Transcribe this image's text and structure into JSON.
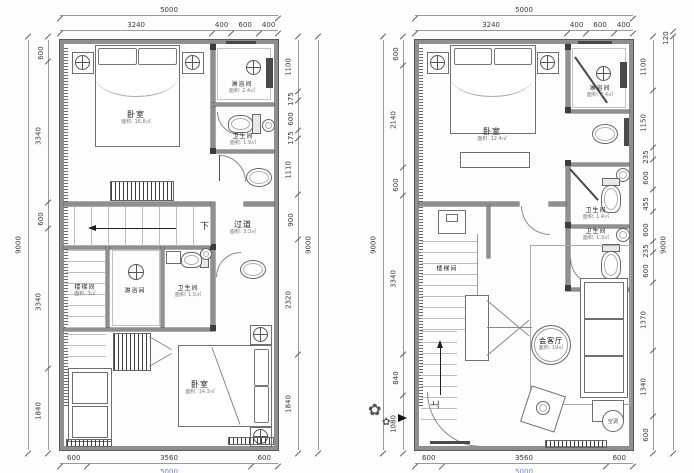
{
  "plans": {
    "left": {
      "dims": {
        "top_overall": [
          "5000"
        ],
        "top": [
          "3240",
          "400",
          "600",
          "400"
        ],
        "left_outer": [
          "9000"
        ],
        "left": [
          "600",
          "3340",
          "600",
          "3340",
          "1840"
        ],
        "right": [
          "1100",
          "175",
          "600",
          "175",
          "1110",
          "900",
          "2320",
          "1840"
        ],
        "right_outer": [
          "9000"
        ],
        "bottom": [
          "600",
          "3560",
          "600"
        ],
        "bottom_overall": [
          "5000"
        ]
      },
      "rooms": {
        "bedroom1": {
          "name": "卧室",
          "area": "面积: 16.8㎡"
        },
        "shower1": {
          "name": "淋浴间",
          "area": "面积: 2.4㎡"
        },
        "toilet1": {
          "name": "卫生间",
          "area": "面积: 1.9㎡"
        },
        "corridor": {
          "name": "过道",
          "area": "面积: 3.3㎡"
        },
        "stairwell": {
          "name": "楼梯间",
          "area": "面积: 3㎡"
        },
        "shower2": {
          "name": "淋浴间",
          "area": "面积: 2.8㎡"
        },
        "toilet2": {
          "name": "卫生间",
          "area": "面积: 1.5㎡"
        },
        "bedroom2": {
          "name": "卧室",
          "area": "面积: 14.3㎡"
        }
      },
      "down_label": "下"
    },
    "right": {
      "dims": {
        "top_overall": [
          "5000"
        ],
        "top": [
          "3240",
          "400",
          "600",
          "400"
        ],
        "left_outer": [
          "9000"
        ],
        "left": [
          "600",
          "2140",
          "600",
          "3340",
          "840",
          "1080"
        ],
        "right": [
          "1100",
          "1150",
          "235",
          "600",
          "455",
          "600",
          "235",
          "600",
          "1370",
          "1340",
          "600"
        ],
        "right_outer": [
          "120",
          "9000"
        ],
        "bottom": [
          "600",
          "3560",
          "600"
        ],
        "bottom_overall": [
          "5000"
        ]
      },
      "rooms": {
        "bedroom": {
          "name": "卧室",
          "area": "面积: 12.4㎡"
        },
        "shower": {
          "name": "淋浴间",
          "area": "面积: 2.4㎡"
        },
        "toilet1": {
          "name": "卫生间",
          "area": "面积: 1.4㎡"
        },
        "toilet2": {
          "name": "卫生间",
          "area": "面积: 1.3㎡"
        },
        "stairwell": {
          "name": "楼梯间",
          "area": ""
        },
        "living": {
          "name": "会客厅",
          "area": "面积: 19㎡"
        },
        "ac": {
          "name": "空调"
        }
      },
      "up_label": "上"
    }
  }
}
